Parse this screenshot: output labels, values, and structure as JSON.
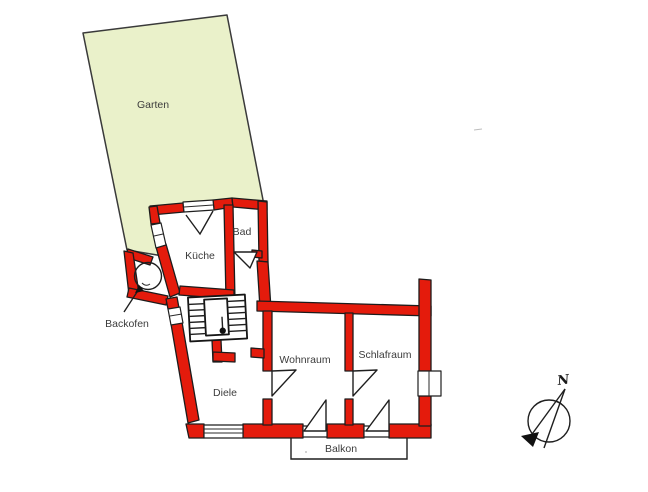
{
  "figure": {
    "type": "floor-plan",
    "description": "Hand-drawn apartment floor plan with garden, red masonry walls, staircase, balcony and north compass"
  },
  "colors": {
    "garden_fill": "#eaf1ca",
    "garden_border": "#3a3a3a",
    "wall_fill": "#e41b0c",
    "wall_outline": "#1c1c1c",
    "line_color": "#1a1a1a",
    "label_text": "#3c3c3c",
    "background": "#ffffff"
  },
  "rooms": [
    {
      "name": "garden",
      "label": "Garten"
    },
    {
      "name": "kitchen",
      "label": "Küche"
    },
    {
      "name": "bathroom",
      "label": "Bad"
    },
    {
      "name": "oven",
      "label": "Backofen"
    },
    {
      "name": "hallway",
      "label": "Diele"
    },
    {
      "name": "living-room",
      "label": "Wohnraum"
    },
    {
      "name": "bedroom",
      "label": "Schlafraum"
    },
    {
      "name": "balcony",
      "label": "Balkon"
    }
  ],
  "compass": {
    "label": "N",
    "direction": "north-northeast"
  },
  "icons": [
    {
      "name": "compass-rose-icon",
      "meaning": "north arrow"
    },
    {
      "name": "oven-circle",
      "meaning": "round bake oven"
    },
    {
      "name": "staircase",
      "meaning": "stairs with direction dot"
    }
  ]
}
